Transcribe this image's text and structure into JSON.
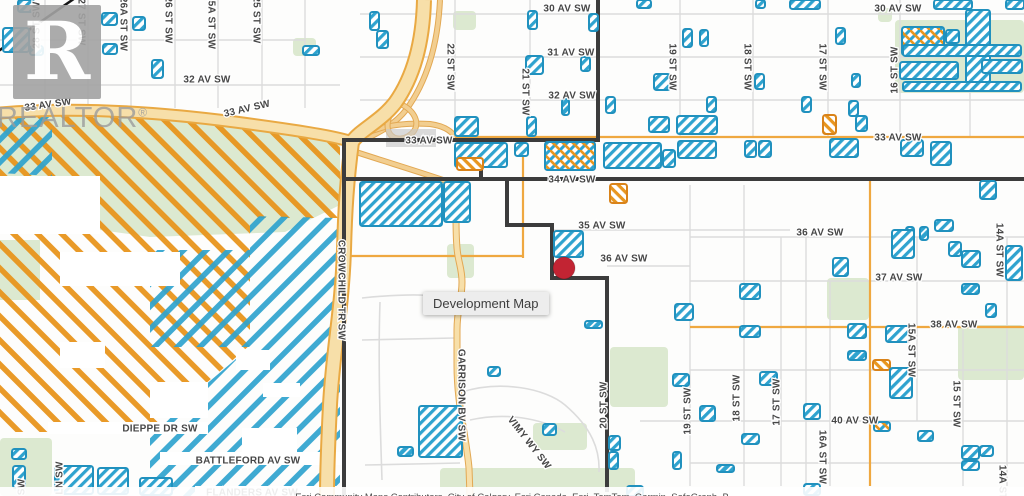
{
  "map": {
    "tooltip_label": "Development Map",
    "attribution": "Esri Community Maps Contributors, City of Calgary, Esri Canada, Esri, TomTom, Garmin, SafeGraph, B",
    "watermark": {
      "logo_letter": "R",
      "brand": "REALTOR",
      "registered": "®"
    },
    "colors": {
      "parcel_blue": "#2fa3cf",
      "parcel_blue_border": "#2191be",
      "parcel_orange": "#e8961f",
      "parcel_orange_border": "#d9831a",
      "zone_orange": "#e8941c",
      "zone_blue": "#2fa3cf",
      "road_major_fill": "#f7dfa9",
      "road_major_casing": "#e9a943",
      "road_ramp_fill": "#f2ce90",
      "road_ramp_casing": "#e2a853",
      "road_orange": "#efa840",
      "road_minor": "#dcdcdc",
      "park_green": "#dce9d0",
      "boundary": "#3c3c3c",
      "marker_red": "#c22433",
      "label_color": "#474747",
      "label_halo": "#ffffff",
      "bridge_grey": "#c8c8c8",
      "rail_black": "#161616"
    },
    "marker": {
      "x": 564,
      "y": 268,
      "r": 11
    },
    "labels": [
      {
        "t": "30 AV SW",
        "x": 567,
        "y": 9
      },
      {
        "t": "30 AV SW",
        "x": 898,
        "y": 9
      },
      {
        "t": "31 AV SW",
        "x": 571,
        "y": 53
      },
      {
        "t": "32 AV SW",
        "x": 207,
        "y": 80
      },
      {
        "t": "32 AV SW",
        "x": 572,
        "y": 96
      },
      {
        "t": "33 AV SW",
        "x": 48,
        "y": 105,
        "r": -8
      },
      {
        "t": "33 AV SW",
        "x": 247,
        "y": 109,
        "r": -13
      },
      {
        "t": "33 AV SW",
        "x": 429,
        "y": 141
      },
      {
        "t": "33 AV SW",
        "x": 898,
        "y": 138
      },
      {
        "t": "34 AV SW",
        "x": 572,
        "y": 180
      },
      {
        "t": "35 AV SW",
        "x": 602,
        "y": 226
      },
      {
        "t": "36 AV SW",
        "x": 624,
        "y": 259
      },
      {
        "t": "36 AV SW",
        "x": 820,
        "y": 233
      },
      {
        "t": "37 AV SW",
        "x": 899,
        "y": 278
      },
      {
        "t": "38 AV SW",
        "x": 954,
        "y": 325
      },
      {
        "t": "40 AV SW",
        "x": 855,
        "y": 421
      },
      {
        "t": "DIEPPE DR SW",
        "x": 160,
        "y": 429
      },
      {
        "t": "BATTLEFORD AV SW",
        "x": 248,
        "y": 461
      },
      {
        "t": "FLANDERS AV SW",
        "x": 252,
        "y": 493
      },
      {
        "t": "28 ST SW",
        "x": 37,
        "y": 25,
        "r": -90
      },
      {
        "t": "27 ST SW",
        "x": 81,
        "y": 22,
        "r": 90
      },
      {
        "t": "26A ST SW",
        "x": 123,
        "y": 24,
        "r": 90
      },
      {
        "t": "26 ST SW",
        "x": 168,
        "y": 20,
        "r": 90
      },
      {
        "t": "25A ST SW",
        "x": 211,
        "y": 22,
        "r": 90
      },
      {
        "t": "25 ST SW",
        "x": 256,
        "y": 20,
        "r": 90
      },
      {
        "t": "22 ST SW",
        "x": 450,
        "y": 67,
        "r": 90
      },
      {
        "t": "21 ST SW",
        "x": 525,
        "y": 92,
        "r": 90
      },
      {
        "t": "19 ST SW",
        "x": 672,
        "y": 67,
        "r": 90
      },
      {
        "t": "18 ST SW",
        "x": 747,
        "y": 67,
        "r": 90
      },
      {
        "t": "17 ST SW",
        "x": 822,
        "y": 67,
        "r": 90
      },
      {
        "t": "16 ST SW",
        "x": 895,
        "y": 70,
        "r": -90
      },
      {
        "t": "CROWCHILD TR SW",
        "x": 341,
        "y": 290,
        "r": 90
      },
      {
        "t": "GARRISON BV SW",
        "x": 461,
        "y": 395,
        "r": 90
      },
      {
        "t": "VIMY WY SW",
        "x": 529,
        "y": 443,
        "r": 52
      },
      {
        "t": "20 ST SW",
        "x": 604,
        "y": 405,
        "r": -90
      },
      {
        "t": "19 ST SW",
        "x": 688,
        "y": 411,
        "r": -90
      },
      {
        "t": "18 ST SW",
        "x": 737,
        "y": 398,
        "r": -90
      },
      {
        "t": "17 ST SW",
        "x": 777,
        "y": 402,
        "r": -90
      },
      {
        "t": "16A ST SW",
        "x": 822,
        "y": 457,
        "r": 90
      },
      {
        "t": "15A ST SW",
        "x": 911,
        "y": 350,
        "r": 90
      },
      {
        "t": "15 ST SW",
        "x": 956,
        "y": 404,
        "r": 90
      },
      {
        "t": "14A ST SW",
        "x": 999,
        "y": 250,
        "r": 90
      },
      {
        "t": "14A ST SW",
        "x": 1002,
        "y": 492,
        "r": 90
      },
      {
        "t": "LN SW",
        "x": 60,
        "y": 478,
        "r": -90
      },
      {
        "t": "SW",
        "x": 22,
        "y": 487,
        "r": -90
      }
    ],
    "parks": [
      [
        293,
        38,
        23,
        18
      ],
      [
        453,
        11,
        23,
        19
      ],
      [
        878,
        8,
        14,
        14
      ],
      [
        895,
        20,
        129,
        73
      ],
      [
        827,
        278,
        42,
        42
      ],
      [
        958,
        325,
        66,
        55
      ],
      [
        610,
        347,
        58,
        60
      ],
      [
        447,
        244,
        27,
        34
      ],
      [
        440,
        468,
        195,
        28
      ],
      [
        533,
        423,
        54,
        27
      ],
      [
        0,
        438,
        52,
        58
      ]
    ],
    "zones": {
      "green": [
        "0,118 85,112 200,121 340,144 340,205 285,232 150,237 100,230 100,186 0,186",
        "0,240 40,240 40,300 0,300"
      ],
      "orange": [
        "0,110 150,114 258,126 340,144 340,218 250,218 250,345 150,432 0,432"
      ],
      "blue": [
        "0,108 52,112 52,176 0,173",
        "250,216 340,218 340,496 150,496 150,432 250,347",
        "150,250 250,250 250,347 150,347"
      ],
      "white": [
        [
          0,
          176,
          100,
          58
        ],
        [
          60,
          252,
          120,
          34
        ],
        [
          236,
          350,
          34,
          20
        ],
        [
          60,
          342,
          45,
          26
        ],
        [
          150,
          382,
          58,
          36
        ],
        [
          242,
          428,
          55,
          24
        ],
        [
          263,
          383,
          37,
          14
        ],
        [
          48,
          422,
          160,
          12
        ],
        [
          160,
          452,
          185,
          13
        ],
        [
          195,
          486,
          150,
          10
        ]
      ]
    },
    "boundary": [
      [
        [
          598,
          0
        ],
        [
          598,
          140
        ]
      ],
      [
        [
          344,
          140
        ],
        [
          598,
          140
        ]
      ],
      [
        [
          344,
          140
        ],
        [
          344,
          496
        ]
      ],
      [
        [
          481,
          140
        ],
        [
          481,
          179
        ]
      ],
      [
        [
          344,
          179
        ],
        [
          1024,
          179
        ]
      ],
      [
        [
          507,
          179
        ],
        [
          507,
          225
        ],
        [
          552,
          225
        ],
        [
          552,
          278
        ],
        [
          607,
          278
        ],
        [
          607,
          490
        ]
      ]
    ],
    "roads": {
      "major": [
        {
          "d": "M424,0 C423,40 415,75 395,103 C380,122 360,130 352,142",
          "w": 12
        },
        {
          "d": "M352,142 C347,180 345,210 344,250 C342,310 333,350 330,405 C328,445 327,470 327,496",
          "w": 12
        },
        {
          "d": "M0,113 C70,107 150,111 235,122 C295,130 335,136 352,142",
          "w": 9
        }
      ],
      "ramps": [
        "M440,0 C438,42 428,80 406,110 C395,124 380,132 368,138",
        "M352,142 C370,128 395,122 430,124 C445,126 452,132 455,137",
        "M350,150 C380,160 420,172 452,183",
        "M398,103 C414,109 420,122 414,131 C407,140 395,141 390,134 C385,127 388,112 398,103"
      ],
      "tan_minor": [
        "M455,182 C457,205 455,225 457,248 C458,262 462,268 462,282 C462,300 457,308 457,330 L457,365 C457,405 466,435 469,468 L470,496"
      ],
      "orange": [
        "M455,137 L1024,137",
        "M523,142 L523,258",
        "M345,256 L523,256",
        "M870,179 L870,486",
        "M690,327 L1024,327"
      ],
      "grey_h": [
        [
          360,
          14,
          1024
        ],
        [
          360,
          57,
          1024
        ],
        [
          360,
          100,
          1024
        ],
        [
          0,
          40,
          305
        ],
        [
          0,
          85,
          340
        ],
        [
          552,
          230,
          790
        ],
        [
          607,
          266,
          690
        ],
        [
          690,
          237,
          1024
        ],
        [
          690,
          281,
          1024
        ],
        [
          690,
          370,
          1024
        ],
        [
          640,
          421,
          1024
        ],
        [
          690,
          463,
          1024
        ]
      ],
      "grey_v": [
        [
          45,
          0,
          108
        ],
        [
          88,
          0,
          108
        ],
        [
          131,
          0,
          108
        ],
        [
          175,
          0,
          108
        ],
        [
          218,
          0,
          108
        ],
        [
          262,
          0,
          108
        ],
        [
          305,
          0,
          108
        ],
        [
          455,
          0,
          140
        ],
        [
          530,
          0,
          140
        ],
        [
          598,
          0,
          140
        ],
        [
          680,
          0,
          137
        ],
        [
          753,
          0,
          137
        ],
        [
          828,
          0,
          137
        ],
        [
          900,
          0,
          137
        ],
        [
          970,
          0,
          137
        ],
        [
          690,
          185,
          486
        ],
        [
          744,
          185,
          486
        ],
        [
          781,
          237,
          486
        ],
        [
          830,
          281,
          486
        ],
        [
          917,
          237,
          421
        ],
        [
          963,
          330,
          486
        ],
        [
          1007,
          237,
          486
        ],
        [
          806,
          237,
          486
        ]
      ],
      "grey_curves": [
        "M362,298 C420,292 445,296 457,300",
        "M462,392 C500,380 545,388 565,405 C592,428 600,450 599,472",
        "M380,302 C378,360 380,420 382,480",
        "M362,340 L455,338",
        "M365,465 L460,463",
        "M470,420 C505,412 540,418 565,432"
      ],
      "rail": "M-3,52 L78,-4",
      "bridge": [
        386,
        129,
        50,
        18
      ]
    },
    "parcels": [
      [
        18,
        0,
        16,
        12,
        "b"
      ],
      [
        3,
        28,
        26,
        24,
        "b"
      ],
      [
        30,
        46,
        13,
        9,
        "b"
      ],
      [
        102,
        13,
        15,
        12,
        "b"
      ],
      [
        103,
        44,
        14,
        10,
        "b"
      ],
      [
        133,
        17,
        12,
        13,
        "b"
      ],
      [
        152,
        60,
        11,
        18,
        "b"
      ],
      [
        303,
        46,
        16,
        9,
        "b"
      ],
      [
        370,
        12,
        9,
        18,
        "b"
      ],
      [
        377,
        31,
        11,
        17,
        "b"
      ],
      [
        528,
        11,
        9,
        18,
        "b"
      ],
      [
        589,
        14,
        9,
        17,
        "b"
      ],
      [
        526,
        56,
        17,
        18,
        "b"
      ],
      [
        581,
        57,
        9,
        14,
        "b"
      ],
      [
        562,
        99,
        7,
        16,
        "s"
      ],
      [
        527,
        117,
        9,
        19,
        "b"
      ],
      [
        455,
        117,
        23,
        19,
        "b"
      ],
      [
        606,
        97,
        9,
        16,
        "b"
      ],
      [
        683,
        29,
        9,
        18,
        "b"
      ],
      [
        700,
        30,
        8,
        16,
        "b"
      ],
      [
        755,
        74,
        9,
        15,
        "b"
      ],
      [
        836,
        28,
        9,
        16,
        "b"
      ],
      [
        852,
        74,
        8,
        13,
        "b"
      ],
      [
        654,
        74,
        16,
        16,
        "b"
      ],
      [
        707,
        97,
        9,
        15,
        "b"
      ],
      [
        802,
        97,
        9,
        15,
        "b"
      ],
      [
        849,
        101,
        9,
        15,
        "b"
      ],
      [
        823,
        115,
        13,
        19,
        "o"
      ],
      [
        856,
        116,
        11,
        15,
        "b"
      ],
      [
        649,
        117,
        20,
        15,
        "b"
      ],
      [
        677,
        116,
        40,
        18,
        "b"
      ],
      [
        637,
        0,
        14,
        8,
        "b"
      ],
      [
        756,
        0,
        9,
        8,
        "b"
      ],
      [
        790,
        0,
        30,
        9,
        "b"
      ],
      [
        934,
        0,
        38,
        9,
        "b"
      ],
      [
        902,
        27,
        42,
        28,
        "x"
      ],
      [
        946,
        30,
        13,
        13,
        "b"
      ],
      [
        966,
        10,
        24,
        78,
        "b"
      ],
      [
        903,
        45,
        118,
        11,
        "b"
      ],
      [
        900,
        62,
        58,
        17,
        "b"
      ],
      [
        982,
        60,
        40,
        13,
        "b"
      ],
      [
        903,
        82,
        118,
        9,
        "b"
      ],
      [
        1006,
        0,
        18,
        9,
        "b"
      ],
      [
        455,
        143,
        52,
        24,
        "b"
      ],
      [
        457,
        158,
        26,
        12,
        "o"
      ],
      [
        515,
        143,
        13,
        13,
        "b"
      ],
      [
        545,
        142,
        50,
        28,
        "x"
      ],
      [
        604,
        143,
        57,
        25,
        "b"
      ],
      [
        663,
        150,
        12,
        17,
        "b"
      ],
      [
        678,
        141,
        38,
        17,
        "b"
      ],
      [
        745,
        141,
        11,
        16,
        "b"
      ],
      [
        759,
        141,
        12,
        16,
        "b"
      ],
      [
        830,
        139,
        28,
        18,
        "b"
      ],
      [
        931,
        142,
        20,
        23,
        "b"
      ],
      [
        901,
        140,
        22,
        16,
        "b"
      ],
      [
        610,
        184,
        17,
        19,
        "o"
      ],
      [
        360,
        182,
        82,
        44,
        "b"
      ],
      [
        444,
        182,
        26,
        40,
        "b"
      ],
      [
        554,
        231,
        29,
        26,
        "b"
      ],
      [
        980,
        181,
        16,
        18,
        "b"
      ],
      [
        906,
        227,
        8,
        13,
        "s"
      ],
      [
        920,
        227,
        8,
        13,
        "s"
      ],
      [
        833,
        258,
        15,
        18,
        "b"
      ],
      [
        892,
        230,
        22,
        28,
        "b"
      ],
      [
        935,
        220,
        18,
        11,
        "b"
      ],
      [
        962,
        251,
        18,
        16,
        "b"
      ],
      [
        1006,
        246,
        16,
        34,
        "b"
      ],
      [
        949,
        242,
        12,
        14,
        "b"
      ],
      [
        740,
        284,
        20,
        15,
        "b"
      ],
      [
        675,
        304,
        18,
        16,
        "b"
      ],
      [
        740,
        326,
        20,
        11,
        "b"
      ],
      [
        848,
        324,
        18,
        14,
        "b"
      ],
      [
        886,
        326,
        24,
        16,
        "b"
      ],
      [
        962,
        284,
        17,
        10,
        "s"
      ],
      [
        986,
        304,
        10,
        13,
        "b"
      ],
      [
        848,
        351,
        18,
        9,
        "s"
      ],
      [
        873,
        360,
        17,
        10,
        "o"
      ],
      [
        890,
        368,
        22,
        30,
        "b"
      ],
      [
        673,
        374,
        16,
        12,
        "b"
      ],
      [
        760,
        372,
        17,
        13,
        "b"
      ],
      [
        700,
        406,
        15,
        15,
        "b"
      ],
      [
        804,
        404,
        16,
        15,
        "b"
      ],
      [
        419,
        406,
        43,
        51,
        "b"
      ],
      [
        398,
        447,
        15,
        9,
        "s"
      ],
      [
        543,
        424,
        13,
        11,
        "b"
      ],
      [
        585,
        321,
        17,
        7,
        "s"
      ],
      [
        488,
        367,
        12,
        9,
        "b"
      ],
      [
        609,
        436,
        11,
        14,
        "b"
      ],
      [
        609,
        452,
        9,
        17,
        "b"
      ],
      [
        673,
        452,
        8,
        17,
        "b"
      ],
      [
        717,
        465,
        17,
        7,
        "s"
      ],
      [
        742,
        434,
        17,
        10,
        "b"
      ],
      [
        874,
        422,
        16,
        9,
        "x"
      ],
      [
        918,
        431,
        15,
        10,
        "b"
      ],
      [
        962,
        446,
        17,
        13,
        "b"
      ],
      [
        980,
        446,
        13,
        10,
        "b"
      ],
      [
        962,
        461,
        17,
        9,
        "b"
      ],
      [
        804,
        484,
        16,
        11,
        "b"
      ],
      [
        627,
        486,
        16,
        10,
        "b"
      ],
      [
        12,
        449,
        14,
        10,
        "b"
      ],
      [
        13,
        466,
        12,
        22,
        "b"
      ],
      [
        55,
        466,
        38,
        28,
        "b"
      ],
      [
        98,
        468,
        30,
        26,
        "b"
      ],
      [
        140,
        478,
        32,
        17,
        "b"
      ]
    ]
  }
}
